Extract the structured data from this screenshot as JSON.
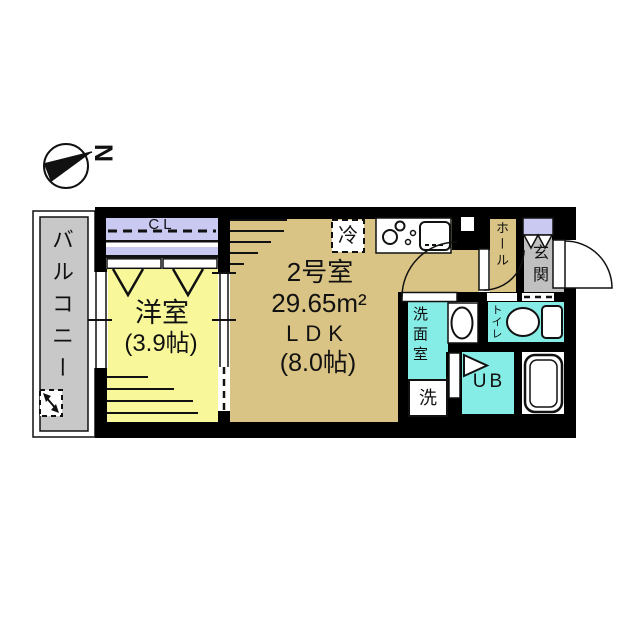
{
  "compass": {
    "north_label": "N"
  },
  "colors": {
    "wall": "#000000",
    "room_yellow": "#f8f89a",
    "room_tan": "#d9c485",
    "room_cyan": "#85ece6",
    "closet_lavender": "#c9c9f2",
    "balcony_gray": "#c8c8c8",
    "entrance_gray": "#c0c0c0"
  },
  "rooms": {
    "balcony": {
      "label": "バルコニー"
    },
    "closet": {
      "label": "CL"
    },
    "western_room": {
      "label": "洋室",
      "size": "(3.9帖)"
    },
    "ldk": {
      "unit": "2号室",
      "area": "29.65m²",
      "label": "LDK",
      "size": "(8.0帖)"
    },
    "refrigerator": {
      "label": "冷"
    },
    "hall": {
      "label": "ホール"
    },
    "entrance": {
      "label": "玄関"
    },
    "toilet": {
      "label": "トイレ"
    },
    "washroom": {
      "label": "洗面室"
    },
    "washing_machine": {
      "label": "洗"
    },
    "unit_bath": {
      "label": "UB"
    }
  }
}
